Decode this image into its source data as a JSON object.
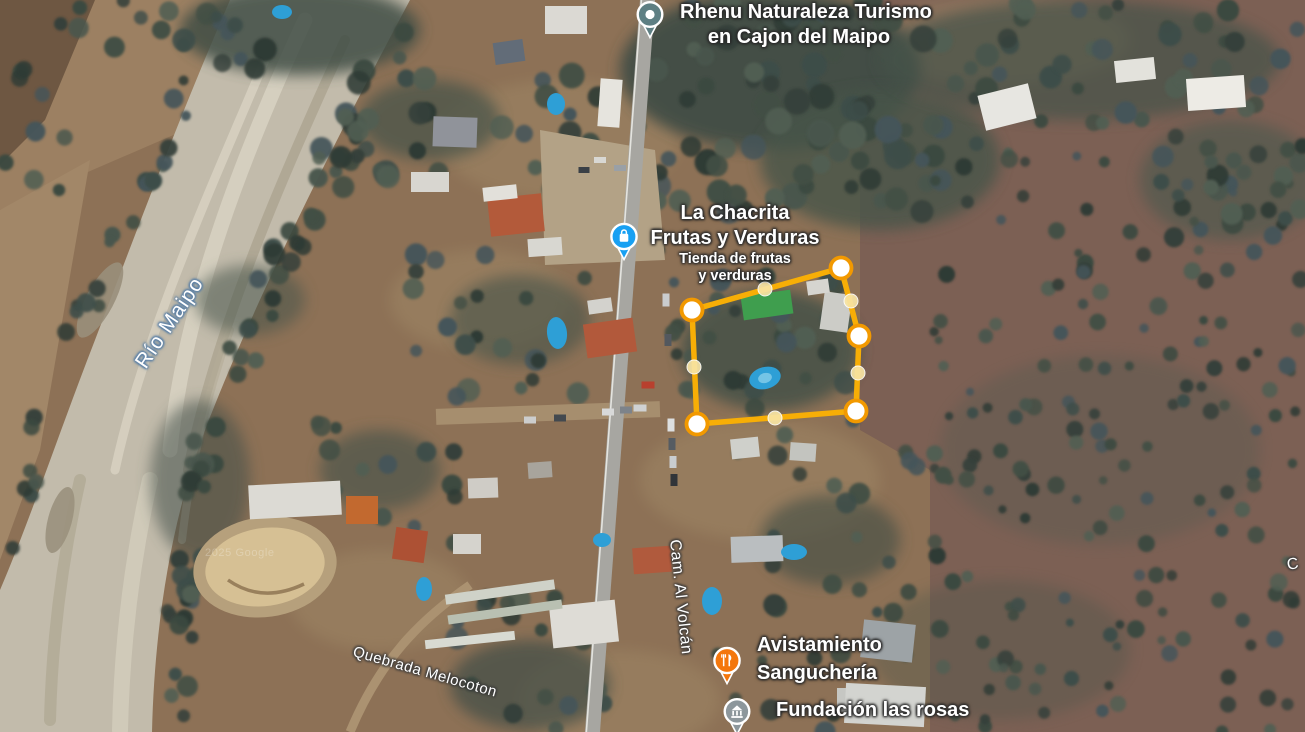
{
  "map": {
    "attribution": "2025 Google",
    "places": [
      {
        "lines": [
          "Rhenu Naturaleza Turismo",
          "en Cajon del Maipo"
        ],
        "icon": "place-pin",
        "icon_color": "#5E7F83"
      },
      {
        "lines": [
          "La Chacrita",
          "Frutas y Verduras"
        ],
        "sub_lines": [
          "Tienda de frutas",
          "y verduras"
        ],
        "icon": "shopping-pin",
        "icon_color": "#18A0F2"
      },
      {
        "lines": [
          "Avistamiento",
          "Sanguchería"
        ],
        "icon": "restaurant-pin",
        "icon_color": "#F4770C"
      },
      {
        "lines": [
          "Fundación las rosas"
        ],
        "icon": "institution-pin",
        "icon_color": "#8D979C"
      }
    ],
    "geo_labels": [
      {
        "text": "Río Maipo",
        "type": "water"
      },
      {
        "text": "Cam. Al Volcán",
        "type": "road"
      },
      {
        "text": "Quebrada Melocoton",
        "type": "water"
      },
      {
        "text": "C",
        "type": "road-partial"
      }
    ],
    "boundary_overlay": {
      "stroke_color": "#F7AE06",
      "vertex_fill": "#FFFFFF",
      "vertex_ring_color": "#F29900",
      "midpoint_fill": "#F9E5A4",
      "vertices": [
        [
          692,
          310
        ],
        [
          841,
          268
        ],
        [
          859,
          336
        ],
        [
          856,
          411
        ],
        [
          697,
          424
        ]
      ],
      "midpoints": [
        [
          765,
          289
        ],
        [
          851,
          301
        ],
        [
          858,
          373
        ],
        [
          775,
          418
        ],
        [
          694,
          367
        ]
      ]
    }
  }
}
